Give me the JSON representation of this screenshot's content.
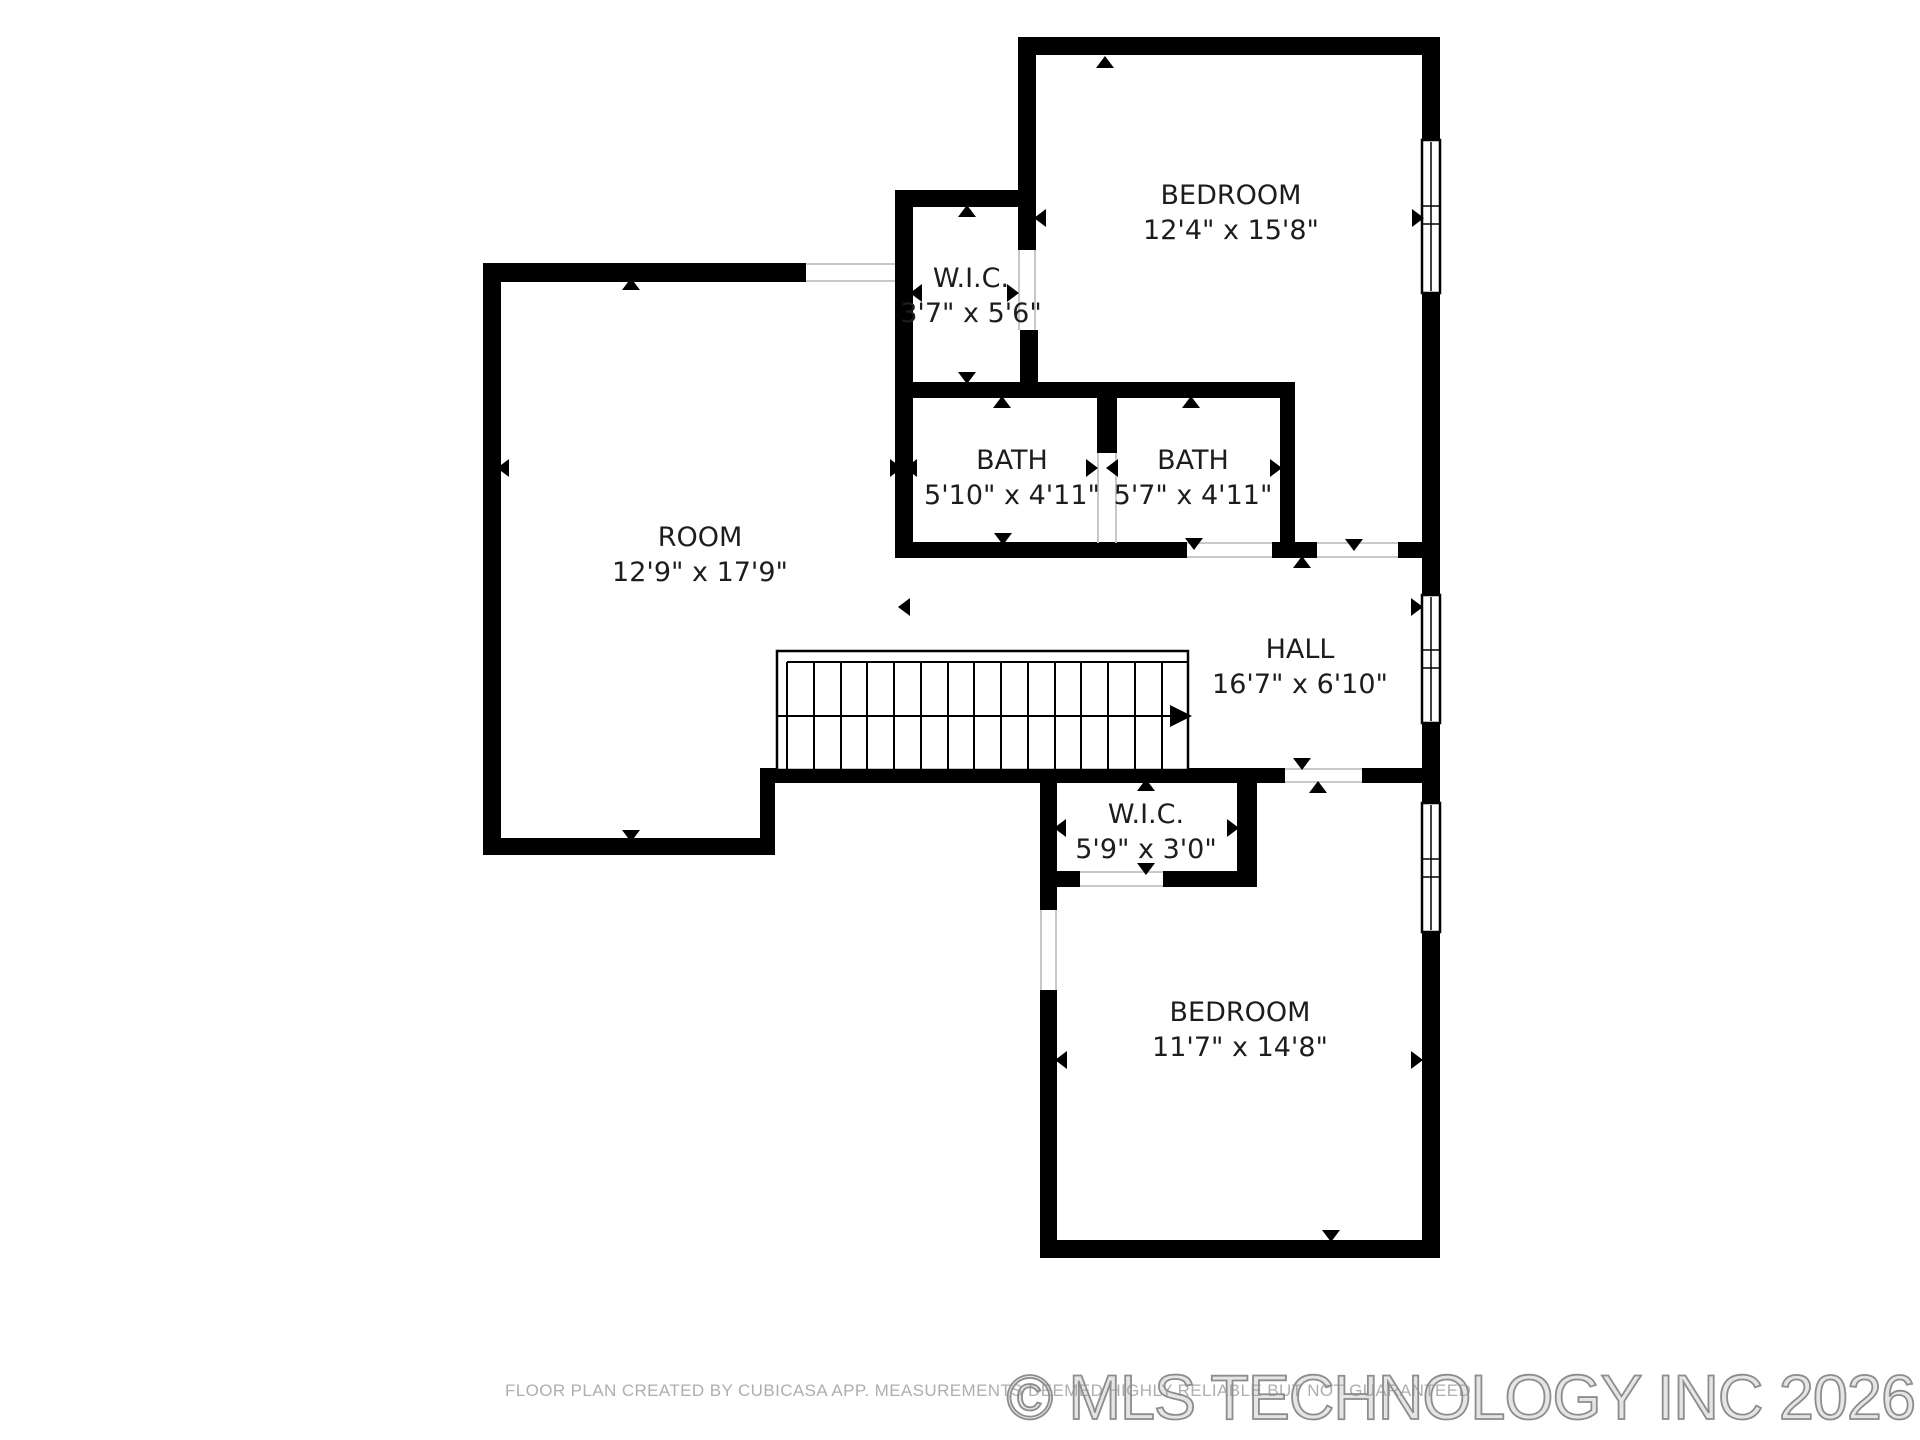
{
  "floorplan": {
    "rooms": [
      {
        "id": "bedroom-top",
        "name": "BEDROOM",
        "dims": "12'4\" x 15'8\""
      },
      {
        "id": "wic-top",
        "name": "W.I.C.",
        "dims": "3'7\" x 5'6\""
      },
      {
        "id": "room",
        "name": "ROOM",
        "dims": "12'9\" x 17'9\""
      },
      {
        "id": "bath-left",
        "name": "BATH",
        "dims": "5'10\" x 4'11\""
      },
      {
        "id": "bath-right",
        "name": "BATH",
        "dims": "5'7\" x 4'11\""
      },
      {
        "id": "hall",
        "name": "HALL",
        "dims": "16'7\" x 6'10\""
      },
      {
        "id": "wic-bottom",
        "name": "W.I.C.",
        "dims": "5'9\" x 3'0\""
      },
      {
        "id": "bedroom-bottom",
        "name": "BEDROOM",
        "dims": "11'7\" x 14'8\""
      }
    ],
    "footer": {
      "disclaimer": "FLOOR PLAN CREATED BY CUBICASA APP. MEASUREMENTS DEEMED HIGHLY RELIABLE BUT NOT GUARANTEED",
      "watermark": "© MLS TECHNOLOGY INC 2026"
    },
    "colors": {
      "wall": "#000000",
      "label": "#1d1d1d",
      "disclaimer_text": "#aeaeae",
      "watermark_text": "#8d8d8d",
      "door_jamb": "#c8c8c8"
    }
  }
}
